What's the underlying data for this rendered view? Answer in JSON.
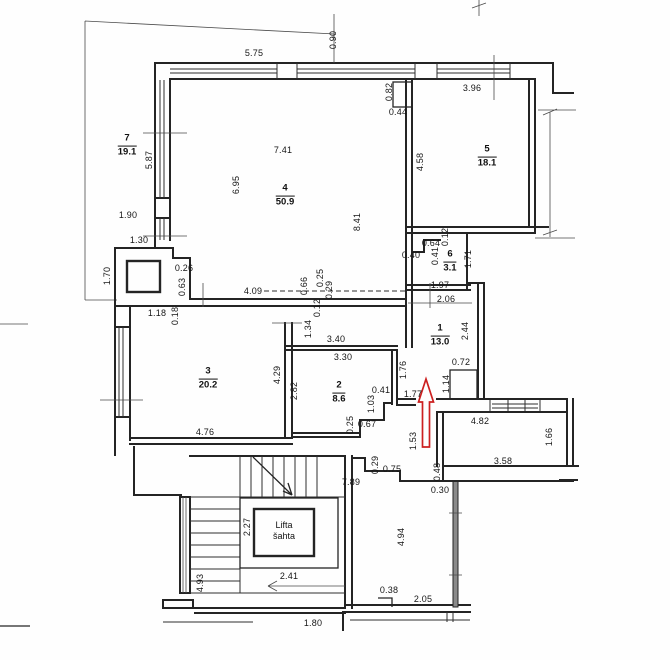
{
  "drawing_type": "apartment floor plan (scanned)",
  "colors": {
    "wall": "#242424",
    "dim_text": "#161616",
    "arrow_red": "#cc2020",
    "window_fill": "#8a8a8a",
    "background": "#fefefe"
  },
  "rooms": [
    {
      "number": "7",
      "area": "19.1",
      "x": 127,
      "y": 146
    },
    {
      "number": "4",
      "area": "50.9",
      "x": 285,
      "y": 196
    },
    {
      "number": "5",
      "area": "18.1",
      "x": 487,
      "y": 157
    },
    {
      "number": "6",
      "area": "3.1",
      "x": 450,
      "y": 262
    },
    {
      "number": "1",
      "area": "13.0",
      "x": 440,
      "y": 336
    },
    {
      "number": "3",
      "area": "20.2",
      "x": 208,
      "y": 379
    },
    {
      "number": "2",
      "area": "8.6",
      "x": 339,
      "y": 393
    }
  ],
  "lift": {
    "line1": "Lifta",
    "line2": "šahta",
    "x": 284,
    "y": 531
  },
  "dimensions": [
    {
      "t": "5.75",
      "x": 254,
      "y": 53,
      "r": 0
    },
    {
      "t": "0.90",
      "x": 333,
      "y": 40,
      "r": 90
    },
    {
      "t": "3.96",
      "x": 472,
      "y": 88,
      "r": 0
    },
    {
      "t": "0.82",
      "x": 389,
      "y": 92,
      "r": 90
    },
    {
      "t": "0.44",
      "x": 398,
      "y": 112,
      "r": 0
    },
    {
      "t": "4.58",
      "x": 420,
      "y": 162,
      "r": 90
    },
    {
      "t": "7.41",
      "x": 283,
      "y": 150,
      "r": 0
    },
    {
      "t": "6.95",
      "x": 236,
      "y": 185,
      "r": 90
    },
    {
      "t": "8.41",
      "x": 357,
      "y": 222,
      "r": 90
    },
    {
      "t": "5.87",
      "x": 149,
      "y": 160,
      "r": 90
    },
    {
      "t": "1.90",
      "x": 128,
      "y": 215,
      "r": 0
    },
    {
      "t": "1.30",
      "x": 139,
      "y": 240,
      "r": 0
    },
    {
      "t": "1.70",
      "x": 107,
      "y": 276,
      "r": 90
    },
    {
      "t": "0.26",
      "x": 184,
      "y": 268,
      "r": 0
    },
    {
      "t": "0.63",
      "x": 182,
      "y": 287,
      "r": 90
    },
    {
      "t": "1.18",
      "x": 157,
      "y": 313,
      "r": 0
    },
    {
      "t": "0.18",
      "x": 175,
      "y": 316,
      "r": 90
    },
    {
      "t": "4.09",
      "x": 253,
      "y": 291,
      "r": 0
    },
    {
      "t": "0.66",
      "x": 304,
      "y": 286,
      "r": 90
    },
    {
      "t": "0.25",
      "x": 320,
      "y": 278,
      "r": 90
    },
    {
      "t": "0.29",
      "x": 329,
      "y": 290,
      "r": 90
    },
    {
      "t": "0.12",
      "x": 317,
      "y": 308,
      "r": 90
    },
    {
      "t": "1.34",
      "x": 308,
      "y": 329,
      "r": 90
    },
    {
      "t": "3.40",
      "x": 336,
      "y": 339,
      "r": 0
    },
    {
      "t": "3.30",
      "x": 343,
      "y": 357,
      "r": 0
    },
    {
      "t": "4.29",
      "x": 277,
      "y": 375,
      "r": 90
    },
    {
      "t": "2.82",
      "x": 294,
      "y": 391,
      "r": 90
    },
    {
      "t": "0.41",
      "x": 381,
      "y": 390,
      "r": 0
    },
    {
      "t": "1.03",
      "x": 371,
      "y": 404,
      "r": 90
    },
    {
      "t": "0.25",
      "x": 350,
      "y": 425,
      "r": 90
    },
    {
      "t": "0.67",
      "x": 367,
      "y": 424,
      "r": 0
    },
    {
      "t": "4.76",
      "x": 205,
      "y": 432,
      "r": 0
    },
    {
      "t": "1.76",
      "x": 403,
      "y": 370,
      "r": 90
    },
    {
      "t": "2.44",
      "x": 465,
      "y": 331,
      "r": 90
    },
    {
      "t": "0.72",
      "x": 461,
      "y": 362,
      "r": 0
    },
    {
      "t": "1.14",
      "x": 446,
      "y": 384,
      "r": 90
    },
    {
      "t": "1.77",
      "x": 413,
      "y": 394,
      "r": 0
    },
    {
      "t": "1.53",
      "x": 413,
      "y": 441,
      "r": 90
    },
    {
      "t": "0.64",
      "x": 431,
      "y": 243,
      "r": 0
    },
    {
      "t": "0.12",
      "x": 445,
      "y": 237,
      "r": 90
    },
    {
      "t": "0.40",
      "x": 411,
      "y": 255,
      "r": 0
    },
    {
      "t": "0.41",
      "x": 435,
      "y": 256,
      "r": 90
    },
    {
      "t": "1.71",
      "x": 468,
      "y": 259,
      "r": 90
    },
    {
      "t": "1.97",
      "x": 440,
      "y": 285,
      "r": 0
    },
    {
      "t": "2.06",
      "x": 446,
      "y": 299,
      "r": 0
    },
    {
      "t": "4.82",
      "x": 480,
      "y": 421,
      "r": 0
    },
    {
      "t": "1.66",
      "x": 549,
      "y": 437,
      "r": 90
    },
    {
      "t": "3.58",
      "x": 503,
      "y": 461,
      "r": 0
    },
    {
      "t": "0.48",
      "x": 437,
      "y": 472,
      "r": 90
    },
    {
      "t": "0.30",
      "x": 440,
      "y": 490,
      "r": 0
    },
    {
      "t": "4.94",
      "x": 401,
      "y": 537,
      "r": 90
    },
    {
      "t": "0.29",
      "x": 375,
      "y": 465,
      "r": 90
    },
    {
      "t": "0.75",
      "x": 392,
      "y": 469,
      "r": 0
    },
    {
      "t": "7.89",
      "x": 351,
      "y": 482,
      "r": 0
    },
    {
      "t": "2.27",
      "x": 247,
      "y": 527,
      "r": 90
    },
    {
      "t": "2.41",
      "x": 289,
      "y": 576,
      "r": 0
    },
    {
      "t": "4.93",
      "x": 200,
      "y": 583,
      "r": 90
    },
    {
      "t": "1.80",
      "x": 313,
      "y": 623,
      "r": 0
    },
    {
      "t": "0.38",
      "x": 389,
      "y": 590,
      "r": 0
    },
    {
      "t": "2.05",
      "x": 423,
      "y": 599,
      "r": 0
    }
  ]
}
